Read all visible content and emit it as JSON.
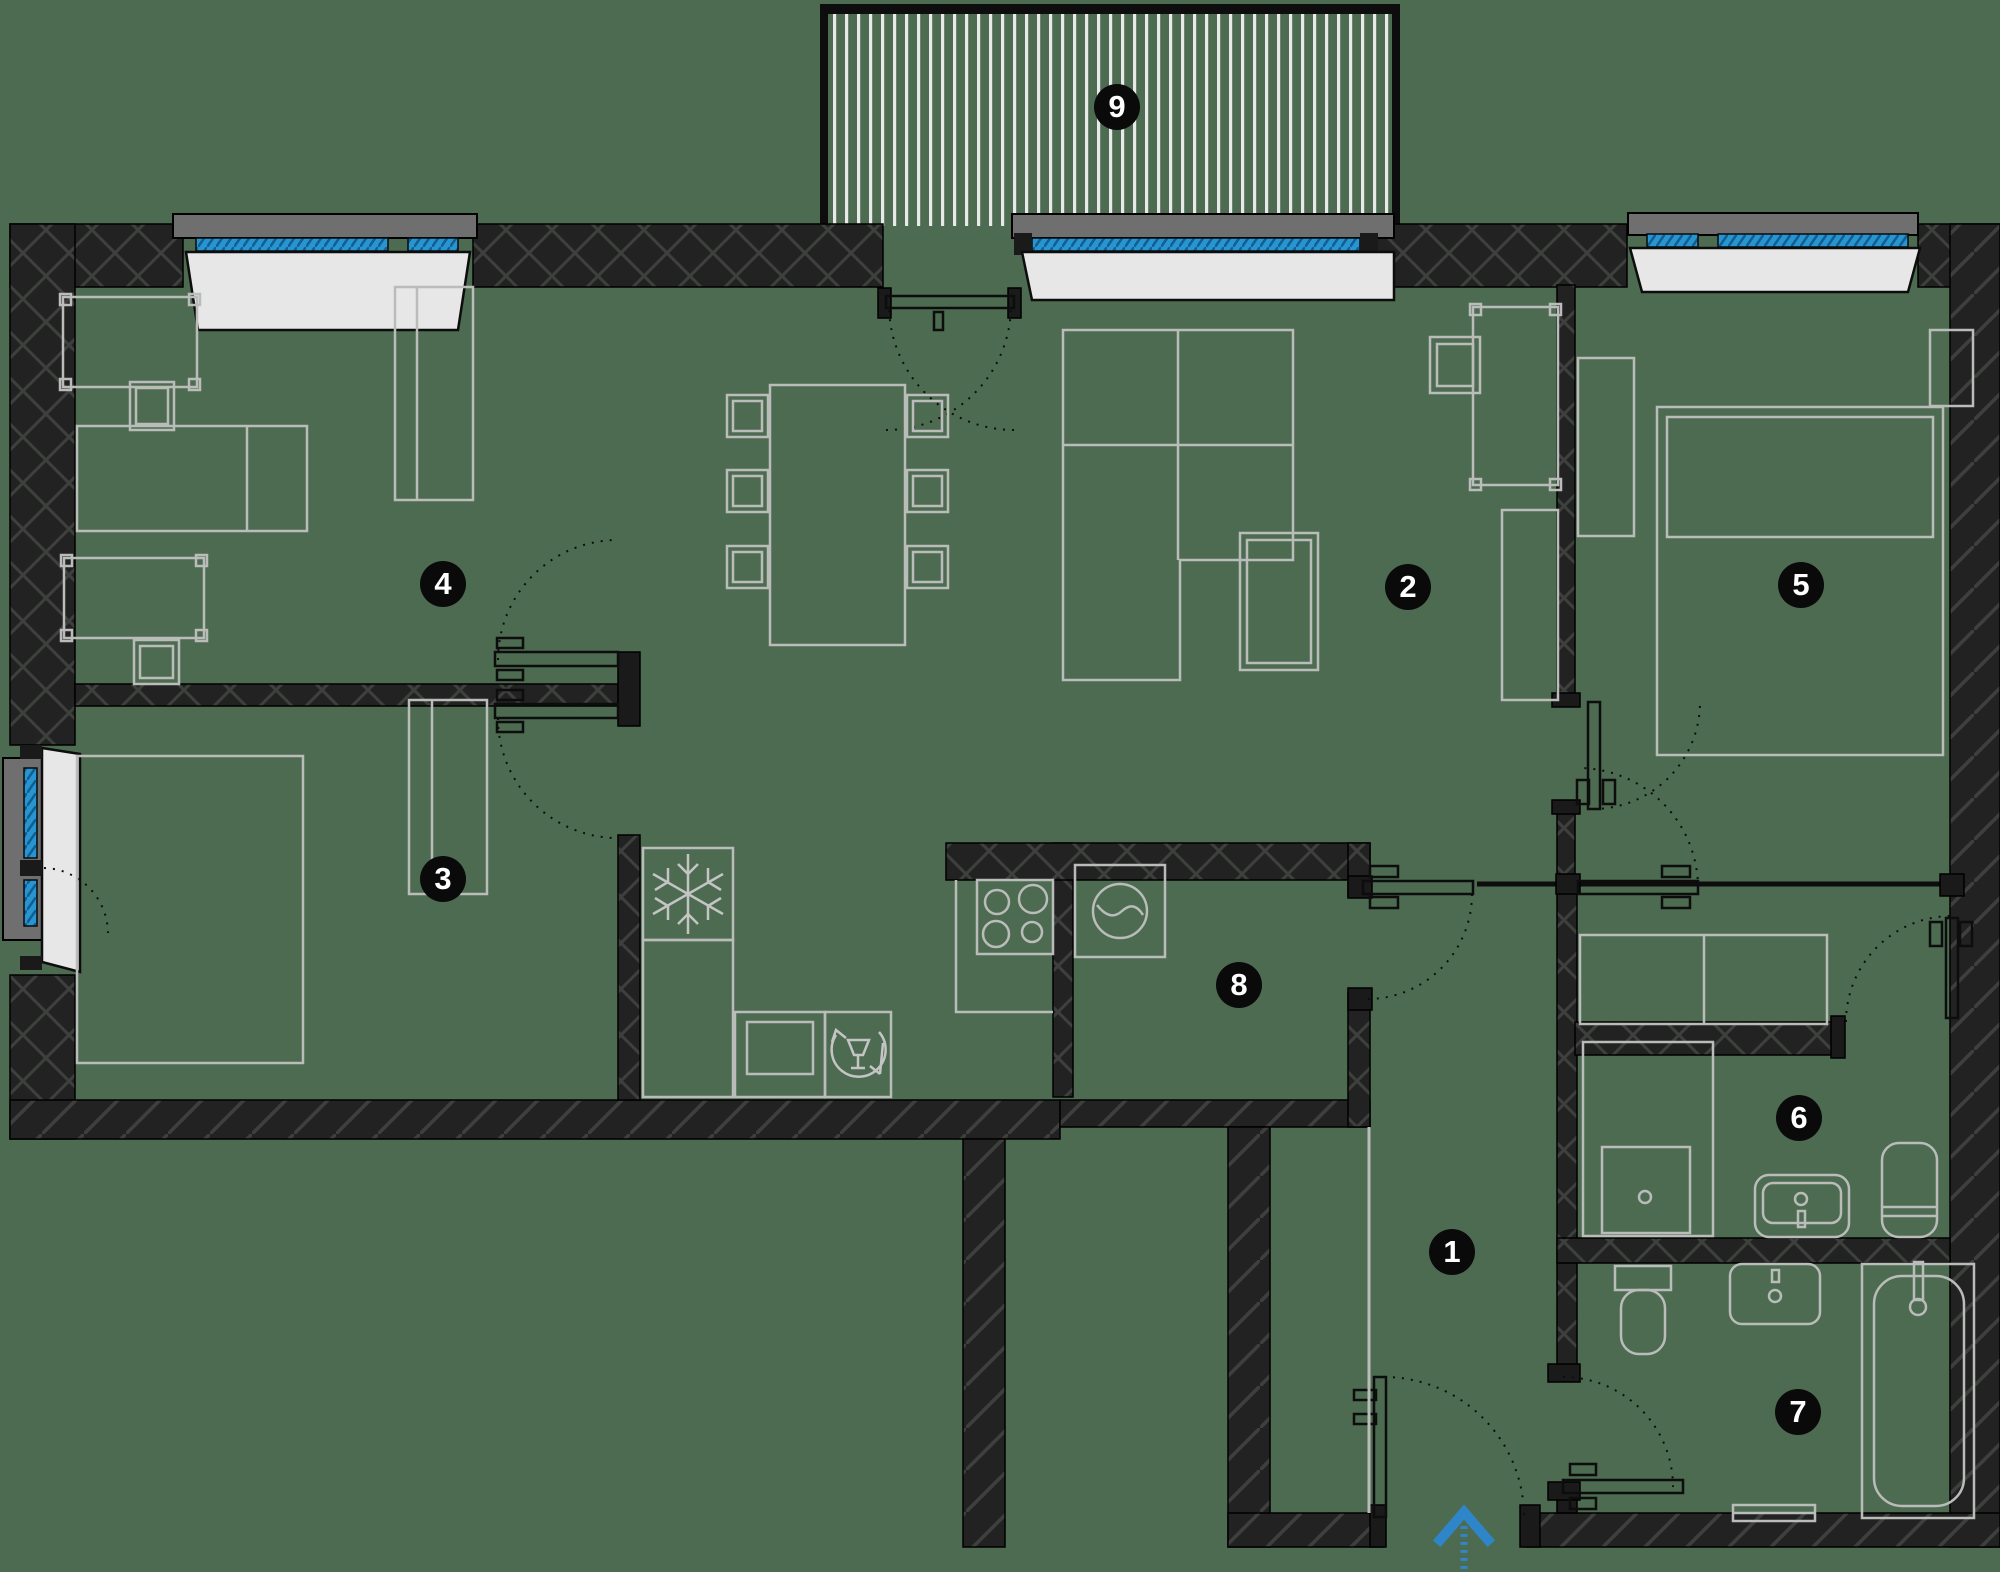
{
  "title": "Apartment floor plan",
  "rooms": [
    {
      "number": "1"
    },
    {
      "number": "2"
    },
    {
      "number": "3"
    },
    {
      "number": "4"
    },
    {
      "number": "5"
    },
    {
      "number": "6"
    },
    {
      "number": "7"
    },
    {
      "number": "8"
    },
    {
      "number": "9"
    }
  ],
  "colors": {
    "background": "#4d6b51",
    "wall": "#212221",
    "wall_hatch": "#3e403e",
    "furniture_line": "#b9bcb9",
    "window_glass": "#2795d2",
    "window_glass_hatch": "#135e8f",
    "window_sill": "#e7e7e7",
    "window_lintel": "#6f6f6f",
    "badge_background": "#0a0a0a",
    "badge_text": "#ffffff",
    "entrance_arrow": "#2e86c8",
    "balcony_stripe": "#e9e9e9",
    "line_black": "#0d0d0d"
  },
  "icons": {
    "entrance_arrow": "up"
  }
}
